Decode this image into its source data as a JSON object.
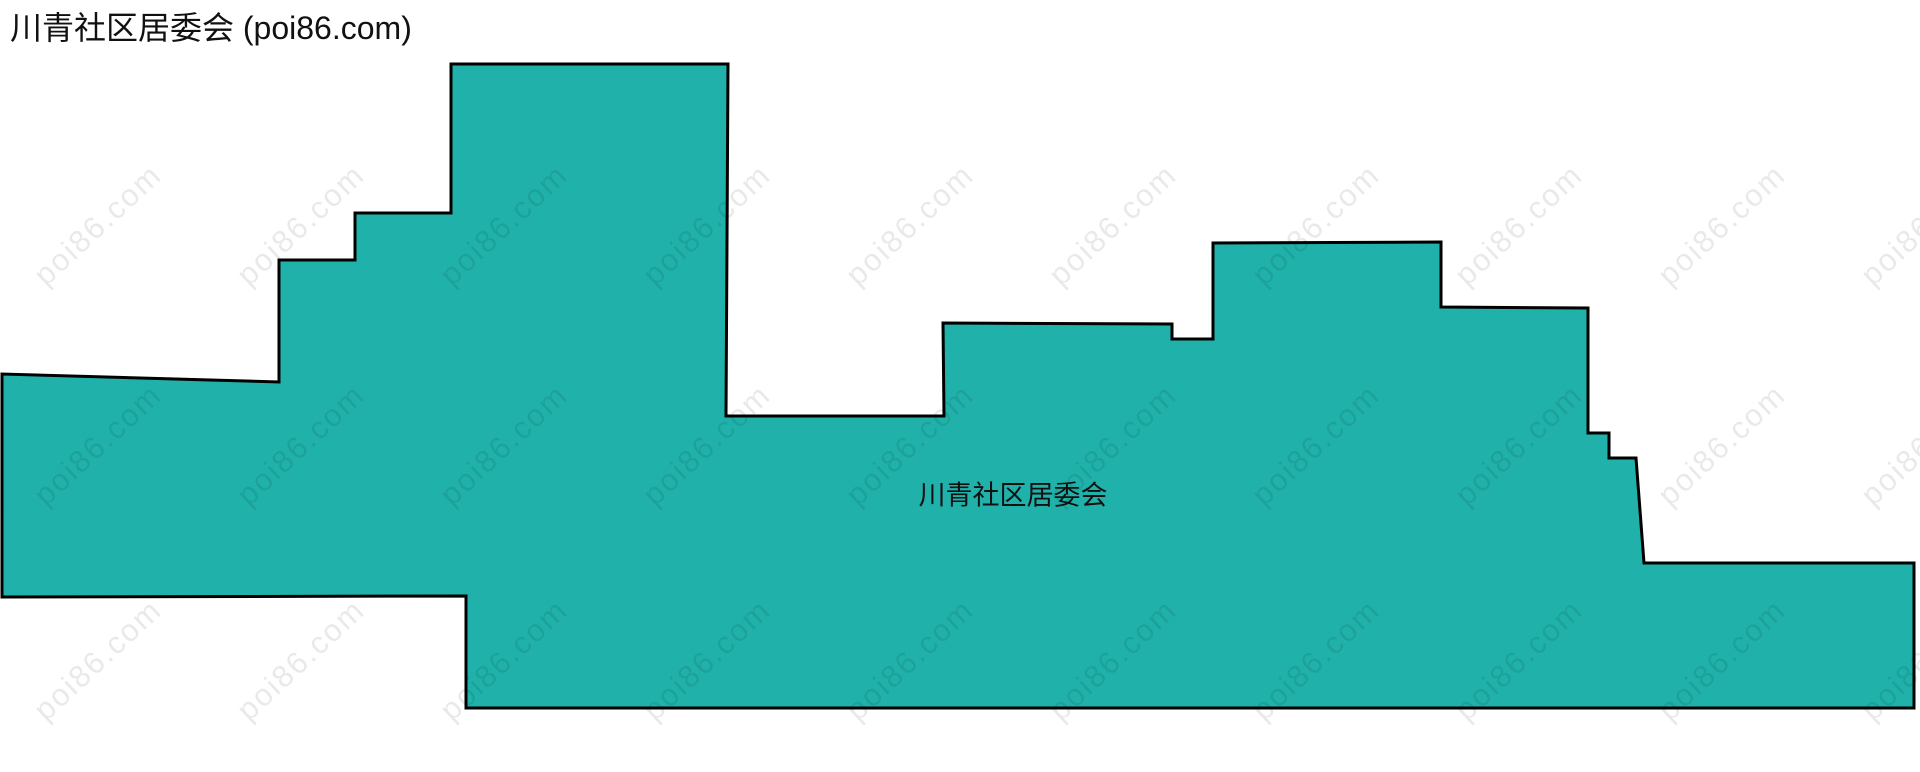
{
  "page": {
    "title": "川青社区居委会 (poi86.com)",
    "region_label": "川青社区居委会"
  },
  "map": {
    "fill_color": "#20B2AA",
    "stroke_color": "#000000",
    "stroke_width": 3,
    "boundary_points": [
      [
        451,
        64
      ],
      [
        728,
        64
      ],
      [
        726,
        416
      ],
      [
        944,
        416
      ],
      [
        943,
        323
      ],
      [
        1172,
        324
      ],
      [
        1172,
        339
      ],
      [
        1213,
        339
      ],
      [
        1213,
        243
      ],
      [
        1441,
        242
      ],
      [
        1441,
        307
      ],
      [
        1588,
        308
      ],
      [
        1588,
        433
      ],
      [
        1609,
        433
      ],
      [
        1609,
        458
      ],
      [
        1636,
        458
      ],
      [
        1644,
        563
      ],
      [
        1914,
        563
      ],
      [
        1914,
        708
      ],
      [
        466,
        708
      ],
      [
        466,
        596
      ],
      [
        2,
        597
      ],
      [
        2,
        374
      ],
      [
        279,
        382
      ],
      [
        279,
        260
      ],
      [
        355,
        260
      ],
      [
        355,
        213
      ],
      [
        451,
        213
      ]
    ],
    "label_position": {
      "x": 1013,
      "y": 493
    }
  },
  "watermark": {
    "text": "poi86.com",
    "color": "rgba(0, 0, 0, 0.085)",
    "font_size": 31,
    "letter_spacing": 2,
    "rotation_deg": -43,
    "columns_x": [
      98,
      301,
      504,
      707,
      910,
      1113,
      1316,
      1519,
      1722,
      1925
    ],
    "rows_y": [
      225,
      445,
      660
    ]
  }
}
